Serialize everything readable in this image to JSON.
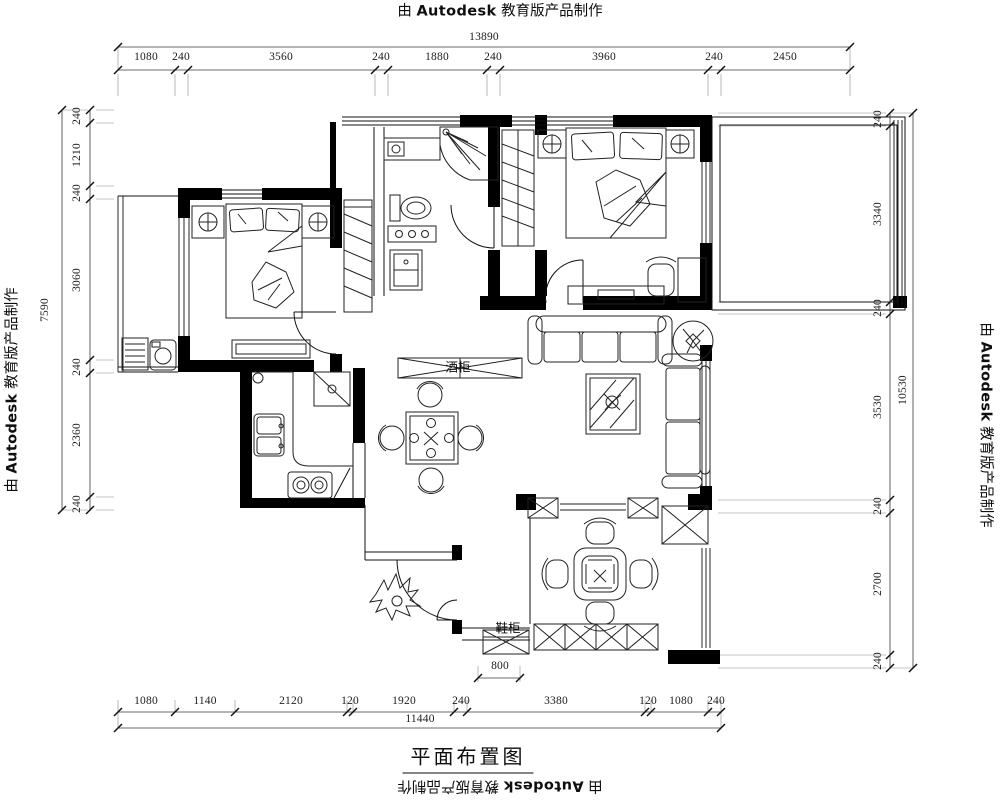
{
  "branding": {
    "prefix": "由",
    "product": "Autodesk",
    "suffix": "教育版产品制作"
  },
  "title": "平面布置图",
  "room_labels": {
    "shoe_cabinet": "鞋柜",
    "wine_cabinet": "酒柜"
  },
  "dimensions": {
    "top": {
      "total": "13890",
      "segments": [
        "1080",
        "240",
        "3560",
        "240",
        "1880",
        "240",
        "3960",
        "240",
        "2450"
      ]
    },
    "bottom": {
      "total": "11440",
      "entry_width": "800",
      "segments": [
        "1080",
        "1140",
        "2120",
        "120",
        "1920",
        "240",
        "3380",
        "120",
        "1080",
        "240"
      ]
    },
    "left": {
      "total": "7590",
      "segments": [
        "240",
        "1210",
        "240",
        "3060",
        "240",
        "2360",
        "240"
      ]
    },
    "right": {
      "total": "10530",
      "segments": [
        "240",
        "3340",
        "240",
        "3530",
        "240",
        "2700",
        "240"
      ]
    }
  },
  "colors": {
    "line": "#1c1c1c",
    "dim_line": "#3a3a3a",
    "background": "#ffffff"
  }
}
